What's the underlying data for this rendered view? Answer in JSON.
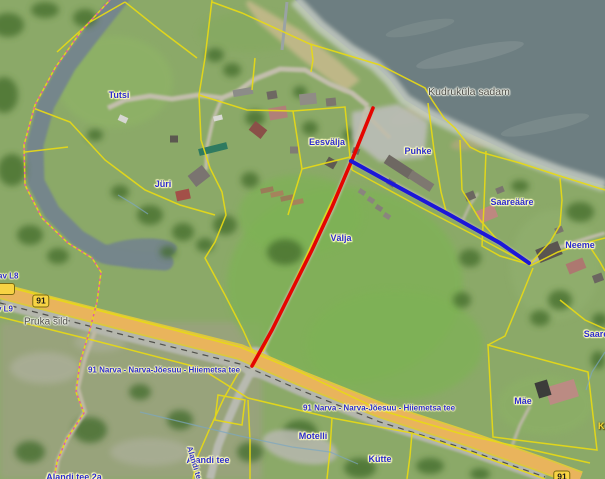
{
  "map_labels": {
    "places": {
      "tutsi": "Tutsi",
      "juri": "Jüri",
      "eesvalja": "Eesvälja",
      "puhke": "Puhke",
      "valja": "Välja",
      "saareaare": "Saareääre",
      "neeme": "Neeme",
      "saare": "Saare",
      "motelli": "Motelli",
      "kutte": "Kütte",
      "mae": "Mäe"
    },
    "harbor_label": "Kudruküla sadam",
    "bridge_label": "Pruka sild",
    "road_91_shield": "91",
    "road_91_name": "91 Narva - Narva-Jõesuu - Hiiemetsa tee",
    "alandi_tee": "Alandi tee",
    "alandi_tee_2a": "Alandi tee 2a",
    "clipped_left_1": "av L8",
    "clipped_left_2": "v L9",
    "clipped_right": "K"
  },
  "legend_colors": {
    "cadastral_boundary_yellow": "#e8da15",
    "municipal_boundary_pink": "#df5aa5",
    "highlighted_route_red": "#e50500",
    "highlighted_route_blue": "#1c17d8",
    "highway_fill_orange": "#e9b45c",
    "water_gray": "#6d7e81"
  }
}
